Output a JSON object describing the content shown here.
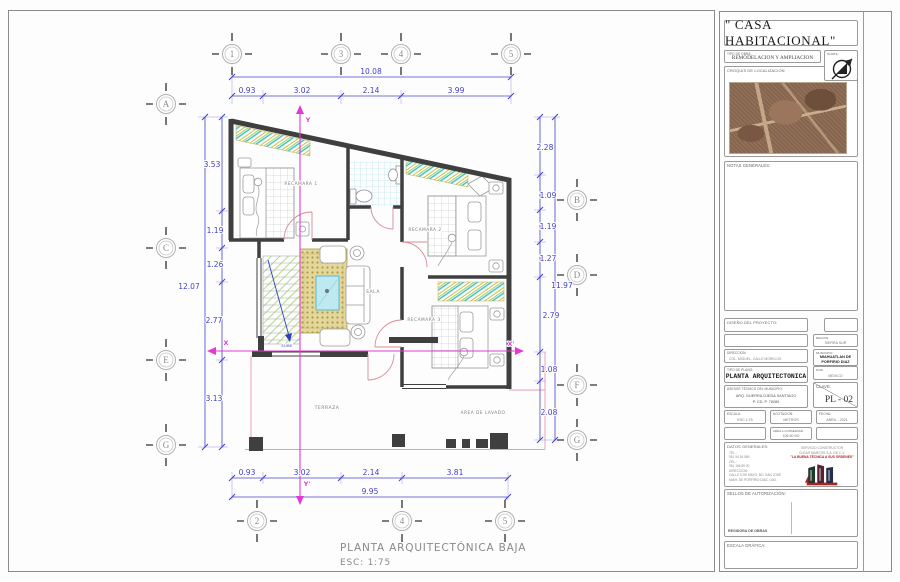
{
  "page": {
    "caption": "PLANTA ARQUITECTÓNICA BAJA",
    "caption_scale": "ESC: 1:75"
  },
  "plan": {
    "grid": {
      "top": [
        "1",
        "3",
        "4",
        "5"
      ],
      "bottom": [
        "2",
        "4",
        "5"
      ],
      "left": [
        "A",
        "C",
        "E",
        "G"
      ],
      "right": [
        "B",
        "D",
        "F",
        "G"
      ]
    },
    "dims": {
      "top_total": "10.08",
      "top": [
        "0.93",
        "3.02",
        "2.14",
        "3.99"
      ],
      "bottom_total": "9.95",
      "bottom": [
        "0.93",
        "3.02",
        "2.14",
        "3.81"
      ],
      "left_total": "12.07",
      "left": [
        "3.53",
        "1.19",
        "1.26",
        "2.77",
        "3.13"
      ],
      "right_total": "11.97",
      "right": [
        "2.28",
        "1.09",
        "1.19",
        "1.27",
        "2.79",
        "1.08",
        "2.08"
      ]
    },
    "rooms": {
      "recamara1": "RECAMARA 1",
      "recamara2": "RECAMARA 2",
      "recamara3": "RECAMARA 3",
      "sala": "SALA",
      "terraza": "TERRAZA",
      "lavado": "AREA DE LAVADO",
      "sube": "SUBE"
    },
    "axes": {
      "y_top": "Y",
      "y_bottom": "Y'",
      "x_left": "X",
      "x_right": "X'"
    }
  },
  "titleblock": {
    "title": "\" CASA HABITACIONAL\"",
    "tipo_obra_label": "TIPO DE OBRA:",
    "tipo_obra": "REMODELACION Y AMPLIACION",
    "norte_label": "NORTE:",
    "croquis_label": "CROQUIS DE LOCALIZACIÓN",
    "notas_label": "NOTAS GENERALES:",
    "diseno_label": "DISEÑO DEL PROYECTO:",
    "region_label": "REGION:",
    "region": "SIERRA SUR",
    "direccion_label": "DIRECCION:",
    "direccion": "COL. MIGUEL, CALLE MORELOS",
    "municipio_label": "MUNICIPIO:",
    "municipio_1": "MIAHUATLAN DE",
    "municipio_2": "PORFIRIO DIAZ",
    "tipo_plano_label": "TIPO DE PLANO:",
    "tipo_plano": "PLANTA ARQUITECTONICA",
    "pais_label": "PAIS:",
    "pais": "MEXICO",
    "asesor_label": "ASESOR TÉCNICO DEL MUNICIPIO:",
    "asesor_1": "ARQ. GUERRA OJEDA SANTIAGO",
    "asesor_2": "P. CD. P. 78280",
    "clave_label": "CLAVE:",
    "clave": "PL - 02",
    "escala_label": "ESCALA:",
    "escala": "ESC 1:75",
    "acotacion_label": "ACOTACION:",
    "acotacion": "METROS",
    "fecha_label": "FECHA:",
    "fecha": "ABRIL - 2021",
    "area_label": "AREA A CONSERVAR:",
    "area": "106.50 M2",
    "datos_label": "DATOS GENERALES:",
    "datos_lines": [
      "TEL.:",
      "951 54 34 565",
      "CEL.:",
      "951 166 89 00",
      "DIRECCION:",
      "CALLE 5 DE MAYO, BO. SAN JOSE",
      "MIAH. DE PORFIRIO DIAZ, OAX."
    ],
    "empresa_1": "SERVICIO CONSTRUCTOR",
    "empresa_2": "CLEAR MARCOS S.A. DE C.V.",
    "empresa_slogan": "\"LA BUENA TÉCNICA A SUS ÓRDENES\"",
    "sellos_label": "SELLOS DE AUTORIZACIÓN:",
    "sellos_firma": "REGIDORA DE OBRAS",
    "escala_grafica_label": "ESCALA GRÁFICA:"
  }
}
